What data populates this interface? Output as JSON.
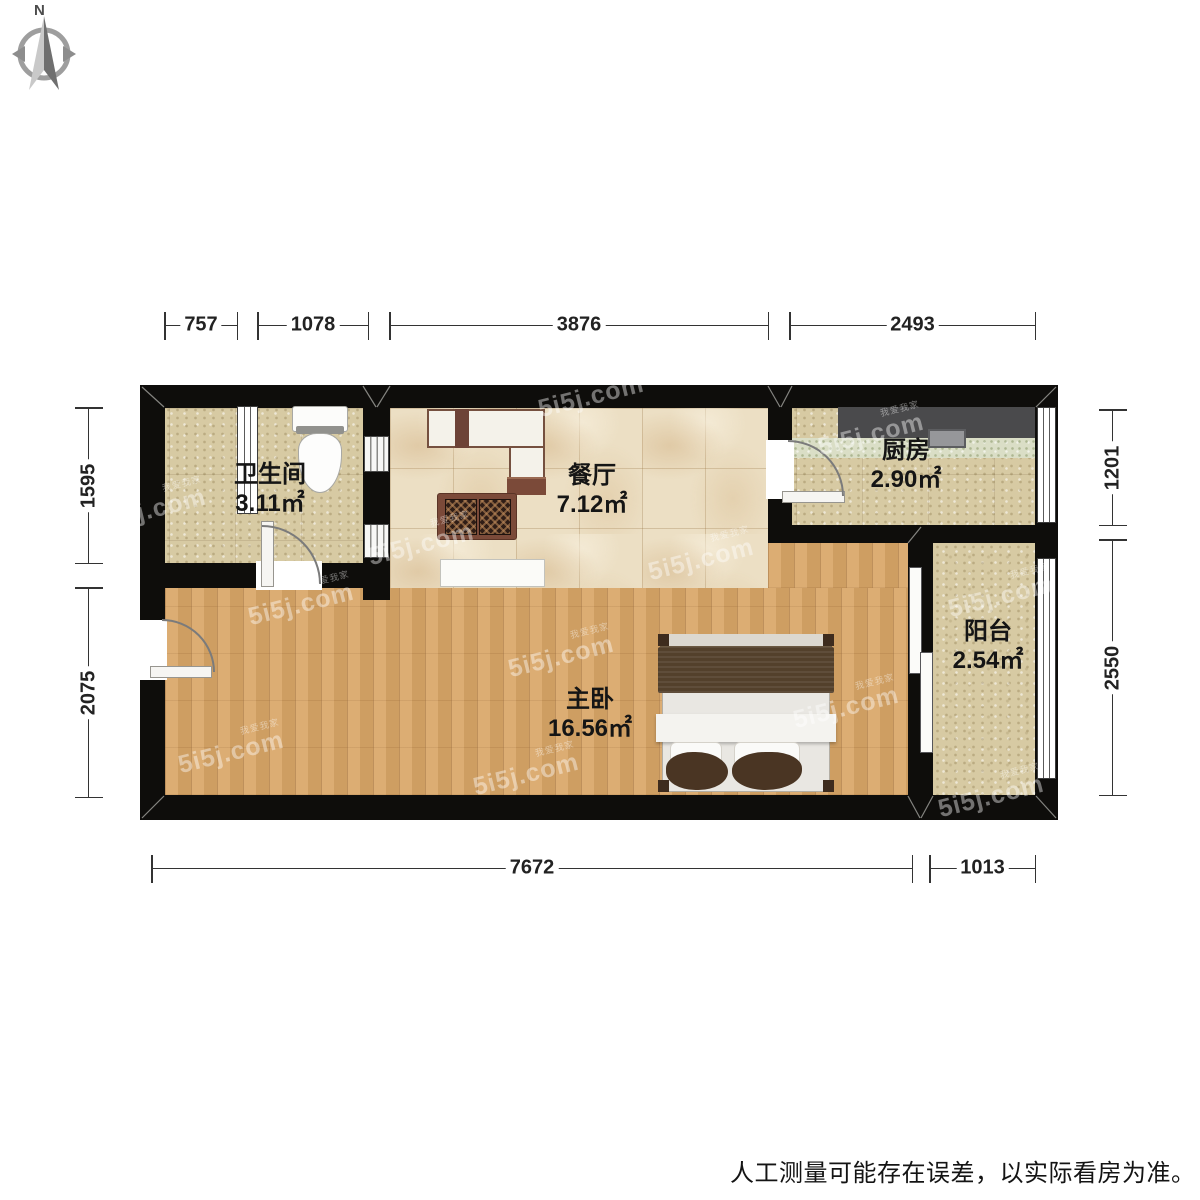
{
  "compass": {
    "north_label": "N"
  },
  "rooms": {
    "bathroom": {
      "name": "卫生间",
      "area": "3.11㎡"
    },
    "dining": {
      "name": "餐厅",
      "area": "7.12㎡"
    },
    "kitchen": {
      "name": "厨房",
      "area": "2.90㎡"
    },
    "bedroom": {
      "name": "主卧",
      "area": "16.56㎡"
    },
    "balcony": {
      "name": "阳台",
      "area": "2.54㎡"
    }
  },
  "dimensions": {
    "top": [
      "757",
      "1078",
      "3876",
      "2493"
    ],
    "left": [
      "1595",
      "2075"
    ],
    "right": [
      "1201",
      "2550"
    ],
    "bottom": [
      "7672",
      "1013"
    ]
  },
  "watermark": {
    "text": "5i5j.com",
    "subtext": "我爱我家"
  },
  "footer": {
    "disclaimer": "人工测量可能存在误差，以实际看房为准。"
  },
  "colors": {
    "wall": "#0e0d0b",
    "wood_floor": "#d9a667",
    "tile_floor": "#d7caa3",
    "marble_floor": "#ecdfc4",
    "counter": "#4a4a4c",
    "furniture_brown": "#7b4a39",
    "bed_blanket": "#53402b"
  }
}
